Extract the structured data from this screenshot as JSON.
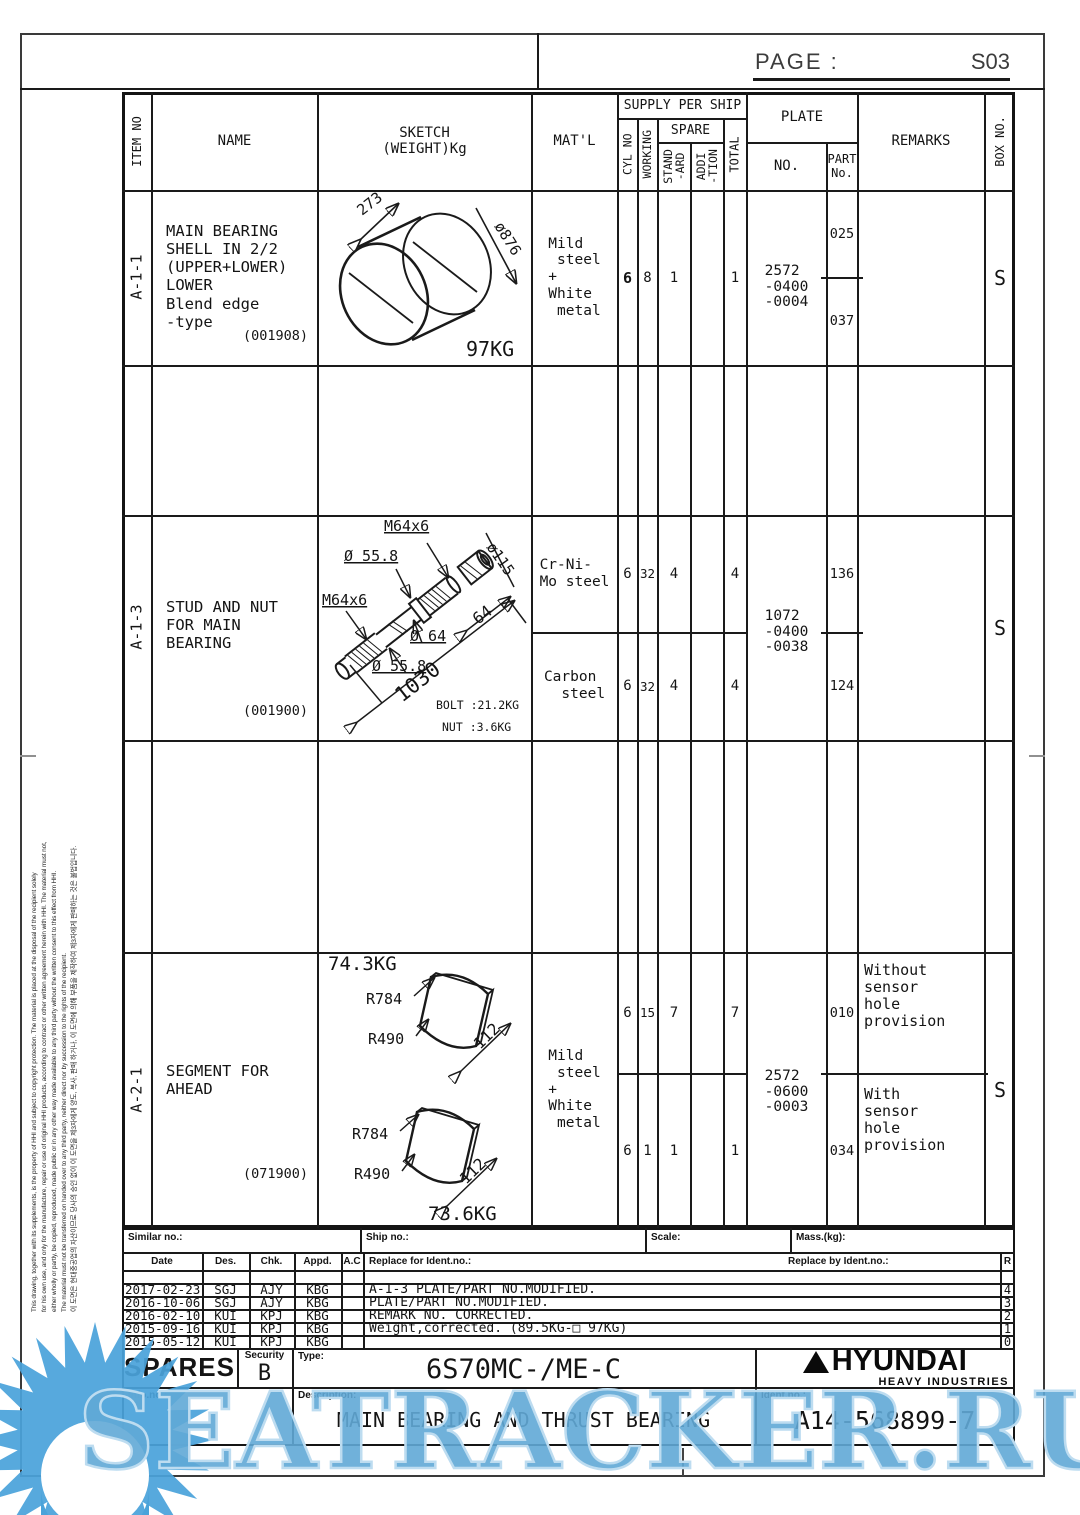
{
  "page_header": {
    "label": "PAGE :",
    "number": "S03"
  },
  "table_header": {
    "item_no": "ITEM NO",
    "name": "NAME",
    "sketch": "SKETCH\n(WEIGHT)Kg",
    "matl": "MAT'L",
    "supply_per_ship": "SUPPLY PER SHIP",
    "cyl_no": "CYL NO",
    "working": "WORKING",
    "spare": "SPARE",
    "standard": "STAND\n-ARD",
    "addition": "ADDI\n-TION",
    "total": "TOTAL",
    "plate": "PLATE",
    "plate_no": "NO.",
    "part_no": "PART\nNo.",
    "remarks": "REMARKS",
    "box_no": "BOX NO."
  },
  "rows": [
    {
      "item_no": "A-1-1",
      "name": "MAIN BEARING\nSHELL IN 2/2\n(UPPER+LOWER)\nLOWER\nBlend edge\n-type",
      "code": "(001908)",
      "sketch": {
        "dim_width": "273",
        "dim_dia": "ø876",
        "weight": "97KG"
      },
      "matl": "Mild\n steel\n+\nWhite\n metal",
      "cyl_no": "6",
      "working": "8",
      "standard": "1",
      "addition": "",
      "total": "1",
      "plate_no": "2572\n-0400\n-0004",
      "part_top": "025",
      "part_bottom": "037",
      "remarks": "",
      "box_no": "S"
    },
    {
      "item_no": "A-1-3",
      "name": "STUD AND NUT\nFOR MAIN\nBEARING",
      "code": "(001900)",
      "sketch": {
        "thread1": "M64x6",
        "dia1": "Ø 55.8",
        "thread2": "M64x6",
        "dia2": "Ø 64",
        "dia3": "Ø 55.8",
        "dia_nut": "ø115",
        "nut_width": "64",
        "length": "1030",
        "bolt_weight": "BOLT :21.2KG",
        "nut_weight": "NUT :3.6KG"
      },
      "matl_top": "Cr-Ni-\nMo steel",
      "matl_bottom": "Carbon\n  steel",
      "sub_top": {
        "cyl_no": "6",
        "working": "32",
        "standard": "4",
        "total": "4",
        "part": "136"
      },
      "sub_bottom": {
        "cyl_no": "6",
        "working": "32",
        "standard": "4",
        "total": "4",
        "part": "124"
      },
      "plate_no": "1072\n-0400\n-0038",
      "box_no": "S"
    },
    {
      "item_no": "A-2-1",
      "name": "SEGMENT FOR\nAHEAD",
      "code": "(071900)",
      "sketch": {
        "weight_top": "74.3KG",
        "r_outer_top": "R784",
        "r_inner_top": "R490",
        "width_top": "112",
        "r_outer_bot": "R784",
        "r_inner_bot": "R490",
        "width_bot": "112",
        "weight_bot": "73.6KG"
      },
      "matl": "Mild\n steel\n+\nWhite\n metal",
      "sub_top": {
        "cyl_no": "6",
        "working": "15",
        "standard": "7",
        "total": "7",
        "part": "010",
        "remark": "Without\nsensor\nhole\nprovision"
      },
      "sub_bottom": {
        "cyl_no": "6",
        "working": "1",
        "standard": "1",
        "total": "1",
        "part": "034",
        "remark": "With\nsensor\nhole\nprovision"
      },
      "plate_no": "2572\n-0600\n-0003",
      "box_no": "S"
    }
  ],
  "info_row": {
    "similar": "Similar no.:",
    "ship": "Ship no.:",
    "scale": "Scale:",
    "mass": "Mass.(kg):"
  },
  "revision": {
    "headers": {
      "date": "Date",
      "des": "Des.",
      "chk": "Chk.",
      "appd": "Appd.",
      "ac": "A.C",
      "replace_for": "Replace for Ident.no.:",
      "replace_by": "Replace by Ident.no.:",
      "r": "R"
    },
    "rows": [
      {
        "date": "2017-02-23",
        "des": "SGJ",
        "chk": "AJY",
        "appd": "KBG",
        "text": "A-1-3 PLATE/PART NO.MODIFIED.",
        "r": "4"
      },
      {
        "date": "2016-10-06",
        "des": "SGJ",
        "chk": "AJY",
        "appd": "KBG",
        "text": "PLATE/PART NO.MODIFIED.",
        "r": "3"
      },
      {
        "date": "2016-02-10",
        "des": "KUI",
        "chk": "KPJ",
        "appd": "KBG",
        "text": "REMARK NO. CORRECTED.",
        "r": "2"
      },
      {
        "date": "2015-09-16",
        "des": "KUI",
        "chk": "KPJ",
        "appd": "KBG",
        "text": "Weight,corrected. (89.5KG-□ 97KG)",
        "r": "1"
      },
      {
        "date": "2015-05-12",
        "des": "KUI",
        "chk": "KPJ",
        "appd": "KBG",
        "text": "",
        "r": "0"
      }
    ]
  },
  "title_block": {
    "spares": "SPARES",
    "security_label": "Security",
    "security_value": "B",
    "type_label": "Type:",
    "type_value": "6S70MC-/ME-C",
    "brand": "HYUNDAI",
    "brand_sub": "HEAVY INDUSTRIES",
    "info_label": "Info.no.:",
    "desc_label": "Description:",
    "desc_value": "MAIN BEARING AND THRUST BEARING",
    "ident_label": "Ident.no.:",
    "ident_value": "A14-568899-7"
  },
  "disclaimer": {
    "en1": "This drawing, together with its supplements, is the property of HHI and subject to copyright protection. The material is placed at the disposal of the recipient solely",
    "en2": "for his own use, and only for the manufacture, repair or use of original HHI products, according to contract or other written agreement herein with HHI. The material must not,",
    "en3": "either wholly or partly, be copied, reproduced, made public or in any other way made available to any third party without the written consent to this effect from HHI.",
    "en4": "The material must not be transferred on handed over to any third party, neither direct nor by succession to the rights of the recipient.",
    "ko": "이 도면은 현대중공업의 자산이므로 당사의 승인 없이 이 도면을 제3자에게 양도, 복사, 판매 하거나, 이 도면에 의해 부품을 제작하여 제3자에게 판매하는 것은 불법입니다."
  },
  "watermark": {
    "text": "SEATRACKER.RU",
    "color": "#60a8d6"
  }
}
